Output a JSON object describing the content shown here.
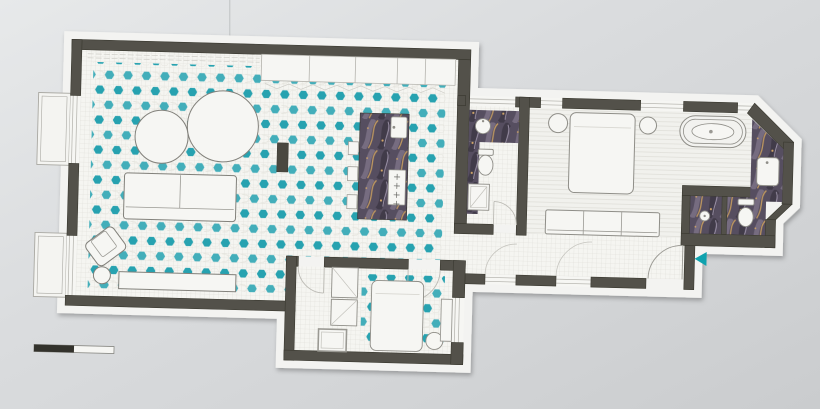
{
  "title": "apartment-floor-plan",
  "colors": {
    "paper_margin": "#f3f3f1",
    "wall": "#53514a",
    "wall_edge": "#39382f",
    "floor_light": "#f5f5f1",
    "grid_line": "#dbdad4",
    "plank_line": "#deddd7",
    "hex_teal_a": "#27a2b0",
    "hex_teal_b": "#43aeba",
    "hex_mesh": "#e4e3dc",
    "outline": "#8f8e88",
    "soft_line": "#bcbbb5",
    "marble_base": "#564e60",
    "marble_shadow": "#3f3947",
    "marble_light": "#7b7186",
    "vein_gold": "#c29a60",
    "vein_light": "#b9aec6",
    "fixture_white": "#f6f6f3",
    "entrance_arrow": "#0fa2ae",
    "scale_bar_dark": "#33322c",
    "paper_line": "#c3c5c7",
    "appliance_dark": "#4a4840"
  },
  "semantics": {
    "areas": [
      "living-room",
      "kitchen-island",
      "guest-bathroom",
      "main-bedroom",
      "open-bathtub",
      "vanity",
      "shower-room",
      "wc",
      "hall-gallery",
      "entrance",
      "second-bedroom",
      "second-bathroom",
      "wardrobes",
      "balconies"
    ],
    "markers": [
      "entrance-arrow",
      "scale-bar"
    ]
  },
  "scale_bar": {
    "segments": 2
  }
}
